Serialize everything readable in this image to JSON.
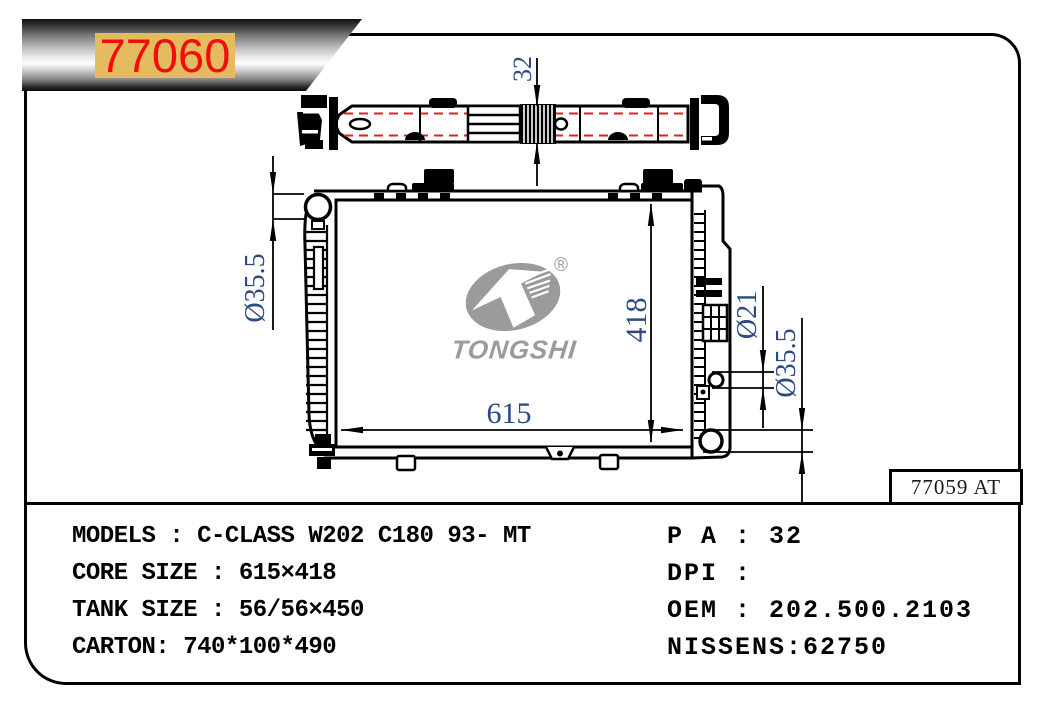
{
  "badge": {
    "part_number": "77060"
  },
  "frame": {
    "ref_label": "77059 AT"
  },
  "logo": {
    "brand": "TONGSHI",
    "registered": "®"
  },
  "dimensions": {
    "tank_depth": "32",
    "core_height": "418",
    "core_width": "615",
    "inlet_diameter": "Ø35.5",
    "port_diameter": "Ø21",
    "outlet_diameter": "Ø35.5"
  },
  "specs": {
    "left": [
      "MODELS : C-CLASS W202 C180 93- MT",
      "CORE SIZE : 615×418",
      "TANK SIZE : 56/56×450",
      "CARTON: 740*100*490"
    ],
    "right": [
      "P A : 32",
      "DPI :",
      "OEM : 202.500.2103",
      "NISSENS:62750"
    ]
  },
  "colors": {
    "accent_red": "#f20d0d",
    "badge_gold": "#e5bb60",
    "dimension_text": "#2a4a80",
    "logo_gray": "#9b9b9b",
    "dashed_red": "#dd2222",
    "line_black": "#000000"
  }
}
